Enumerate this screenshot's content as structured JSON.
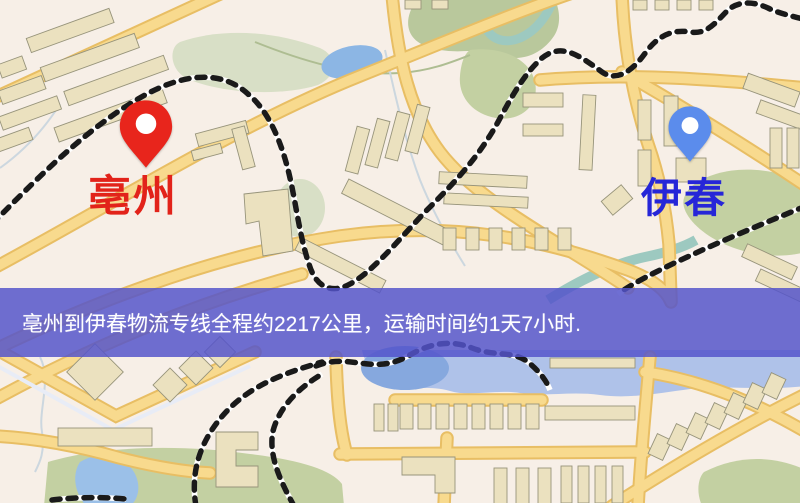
{
  "origin": {
    "label": "亳州"
  },
  "destination": {
    "label": "伊春"
  },
  "banner": {
    "text": "亳州到伊春物流专线全程约2217公里，运输时间约1天7小时.",
    "distance": "约2217公里",
    "duration": "约1天7小时"
  },
  "icons": {
    "origin_pin": "red-map-pin",
    "destination_pin": "blue-map-pin"
  },
  "colors": {
    "origin_pin": "#e8251c",
    "origin_label": "#e2231a",
    "destination_pin": "#5b8cec",
    "destination_label": "#2626d8",
    "banner_bg": "#5454ca",
    "banner_text": "#ffffff",
    "road": "#f8da8e",
    "road_casing": "#e8be64",
    "water": "#8cb6e4",
    "park": "#c3d0a2",
    "railway": "#1a1a1a",
    "background": "#f7efe7"
  }
}
